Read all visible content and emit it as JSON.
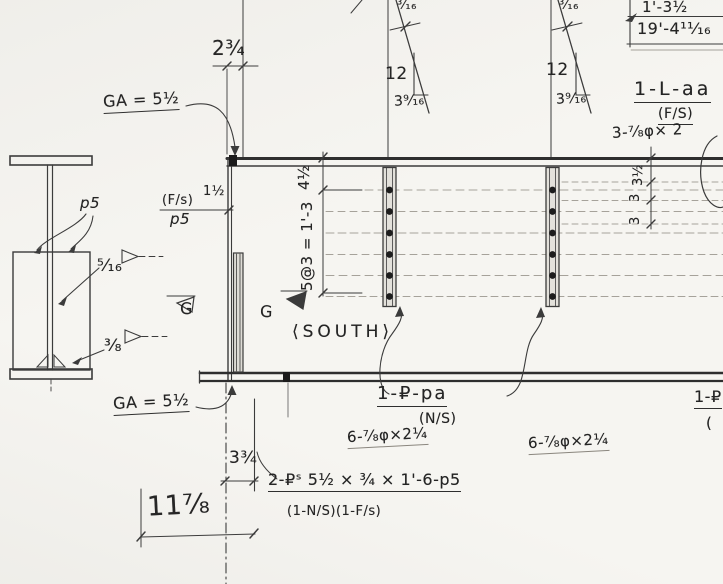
{
  "drawing": {
    "view_name": "⟨SOUTH⟩",
    "section": {
      "plate_label": "p5",
      "web_weld": "⁵⁄₁₆",
      "flange_weld": "³⁄₈"
    },
    "gage": {
      "top": "GA = 5½",
      "bottom": "GA = 5½"
    },
    "dims": {
      "end_offset": "2¾",
      "stiffener_side": "(F/s)",
      "stiffener_offset": "1½",
      "stiffener_plate": "p5",
      "first_row": "4½",
      "row_spacing": "5@3 = 1'-3",
      "right_row_1": "3½",
      "right_row_2": "3",
      "right_row_3": "3",
      "near_span": "1'-3½",
      "total_span": "19'-4¹¹⁄₁₆",
      "plate_offset": "3¾",
      "bottom_width": "11⁷⁄₈"
    },
    "slope": {
      "weld": "³⁄₁₆",
      "rise": "12",
      "run": "3⁹⁄₁₆"
    },
    "angle_callout": {
      "mark": "1-L-aa",
      "side": "(F/S)",
      "bolts": "3-⁷⁄₈φ× 2"
    },
    "splice_callout": {
      "mark": "1-₽-pa",
      "side": "(N/S)",
      "bolts_left": "6-⁷⁄₈φ×2¼",
      "bolts_right": "6-⁷⁄₈φ×2¼"
    },
    "stiffener_callout": {
      "mark": "2-₽ˢ 5½ × ¾ × 1'-6-p5",
      "sides": "(1-N/S)(1-F/s)"
    },
    "edge_callout": {
      "mark": "1-₽",
      "paren": "("
    },
    "section_cut": {
      "label": "G"
    }
  }
}
